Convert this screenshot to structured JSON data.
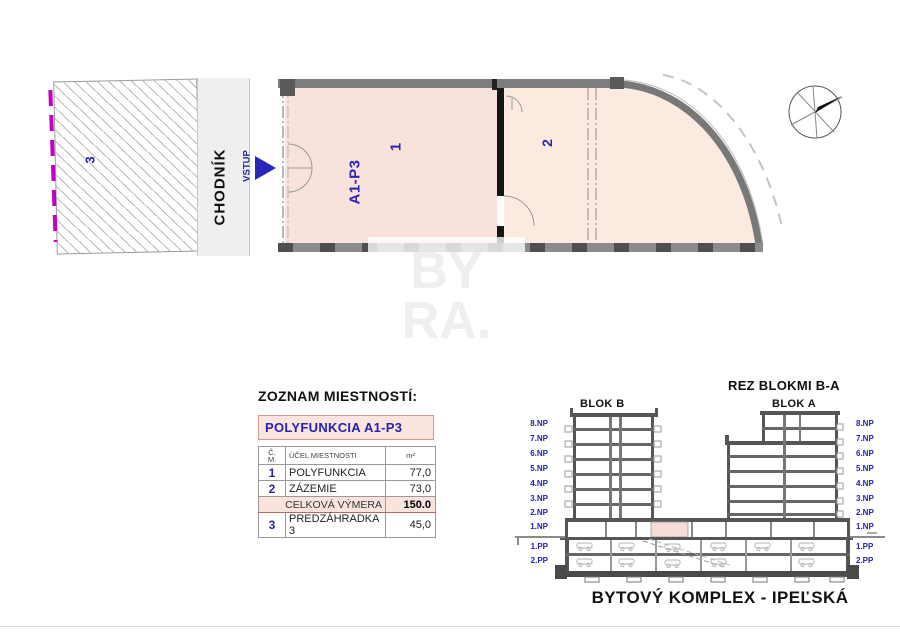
{
  "plan": {
    "room1_code": "A1-P3",
    "room1_num": "1",
    "room2_num": "2",
    "room3_num": "3",
    "sidewalk_label": "CHODNÍK",
    "entrance_label": "VSTUP"
  },
  "room_table": {
    "title": "ZOZNAM MIESTNOSTÍ:",
    "unit_header": "POLYFUNKCIA A1-P3",
    "col_num_line1": "Č.",
    "col_num_line2": "M.",
    "col_purpose": "ÚČEL MIESTNOSTI",
    "col_area": "m²",
    "rows": [
      {
        "num": "1",
        "purpose": "POLYFUNKCIA",
        "area": "77,0"
      },
      {
        "num": "2",
        "purpose": "ZÁZEMIE",
        "area": "73,0"
      }
    ],
    "total_label": "CELKOVÁ VÝMERA",
    "total_value": "150.0",
    "extra_row": {
      "num": "3",
      "purpose": "PREDZÁHRADKA 3",
      "area": "45,0"
    }
  },
  "section": {
    "title": "REZ BLOKMI B-A",
    "block_b_label": "BLOK B",
    "block_a_label": "BLOK A",
    "floors": [
      "8.NP",
      "7.NP",
      "6.NP",
      "5.NP",
      "4.NP",
      "3.NP",
      "2.NP",
      "1.NP",
      "1.PP",
      "2.PP"
    ]
  },
  "footer": {
    "title": "BYTOVÝ KOMPLEX - IPEĽSKÁ"
  },
  "watermark": {
    "line1": "BY",
    "line2": "RA."
  },
  "colors": {
    "room1_fill": "#f9e1dc",
    "room2_fill": "#fbeadf",
    "wall_gray": "#7d7d7d",
    "partition_black": "#161616",
    "label_blue": "#2626ae",
    "table_pink": "#fce5df",
    "magenta_boundary": "#c400c4"
  }
}
